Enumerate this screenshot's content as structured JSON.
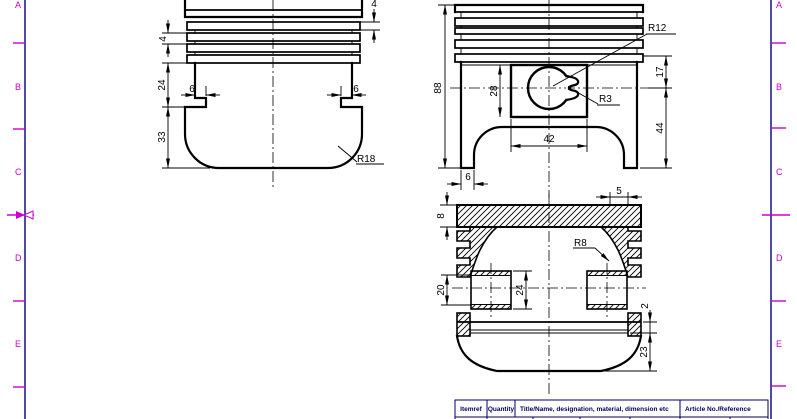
{
  "frame": {
    "border_color": "#000080",
    "zone_color": "#cc00cc",
    "zones": [
      "A",
      "B",
      "C",
      "D",
      "E"
    ]
  },
  "views": {
    "front": {
      "dim_land": "4",
      "dim_ring_belt": "24",
      "dim_relief_left": "6",
      "dim_relief_right": "6",
      "dim_skirt": "33",
      "dim_land_top": "4",
      "label_fillet_radius": "R18"
    },
    "side_section": {
      "dim_height": "88",
      "dim_boss_height": "28",
      "dim_boss_width": "42",
      "dim_foot_width": "6",
      "dim_top_to_pin": "17",
      "dim_pin_to_bottom": "44",
      "label_pin_radius": "R12",
      "label_notch_radius": "R3"
    },
    "bottom_section": {
      "dim_crown_thickness": "8",
      "dim_top_land": "5",
      "label_inner_fillet_radius": "R8",
      "dim_pin_bore": "20",
      "dim_boss_width": "24",
      "dim_ring_land": "2",
      "dim_skirt_height": "23"
    }
  },
  "title_block": {
    "itemref_label": "Itemref",
    "quantity_label": "Quantity",
    "title_label": "Title/Name, designation, material, dimension etc",
    "article_label": "Article No./Reference"
  }
}
